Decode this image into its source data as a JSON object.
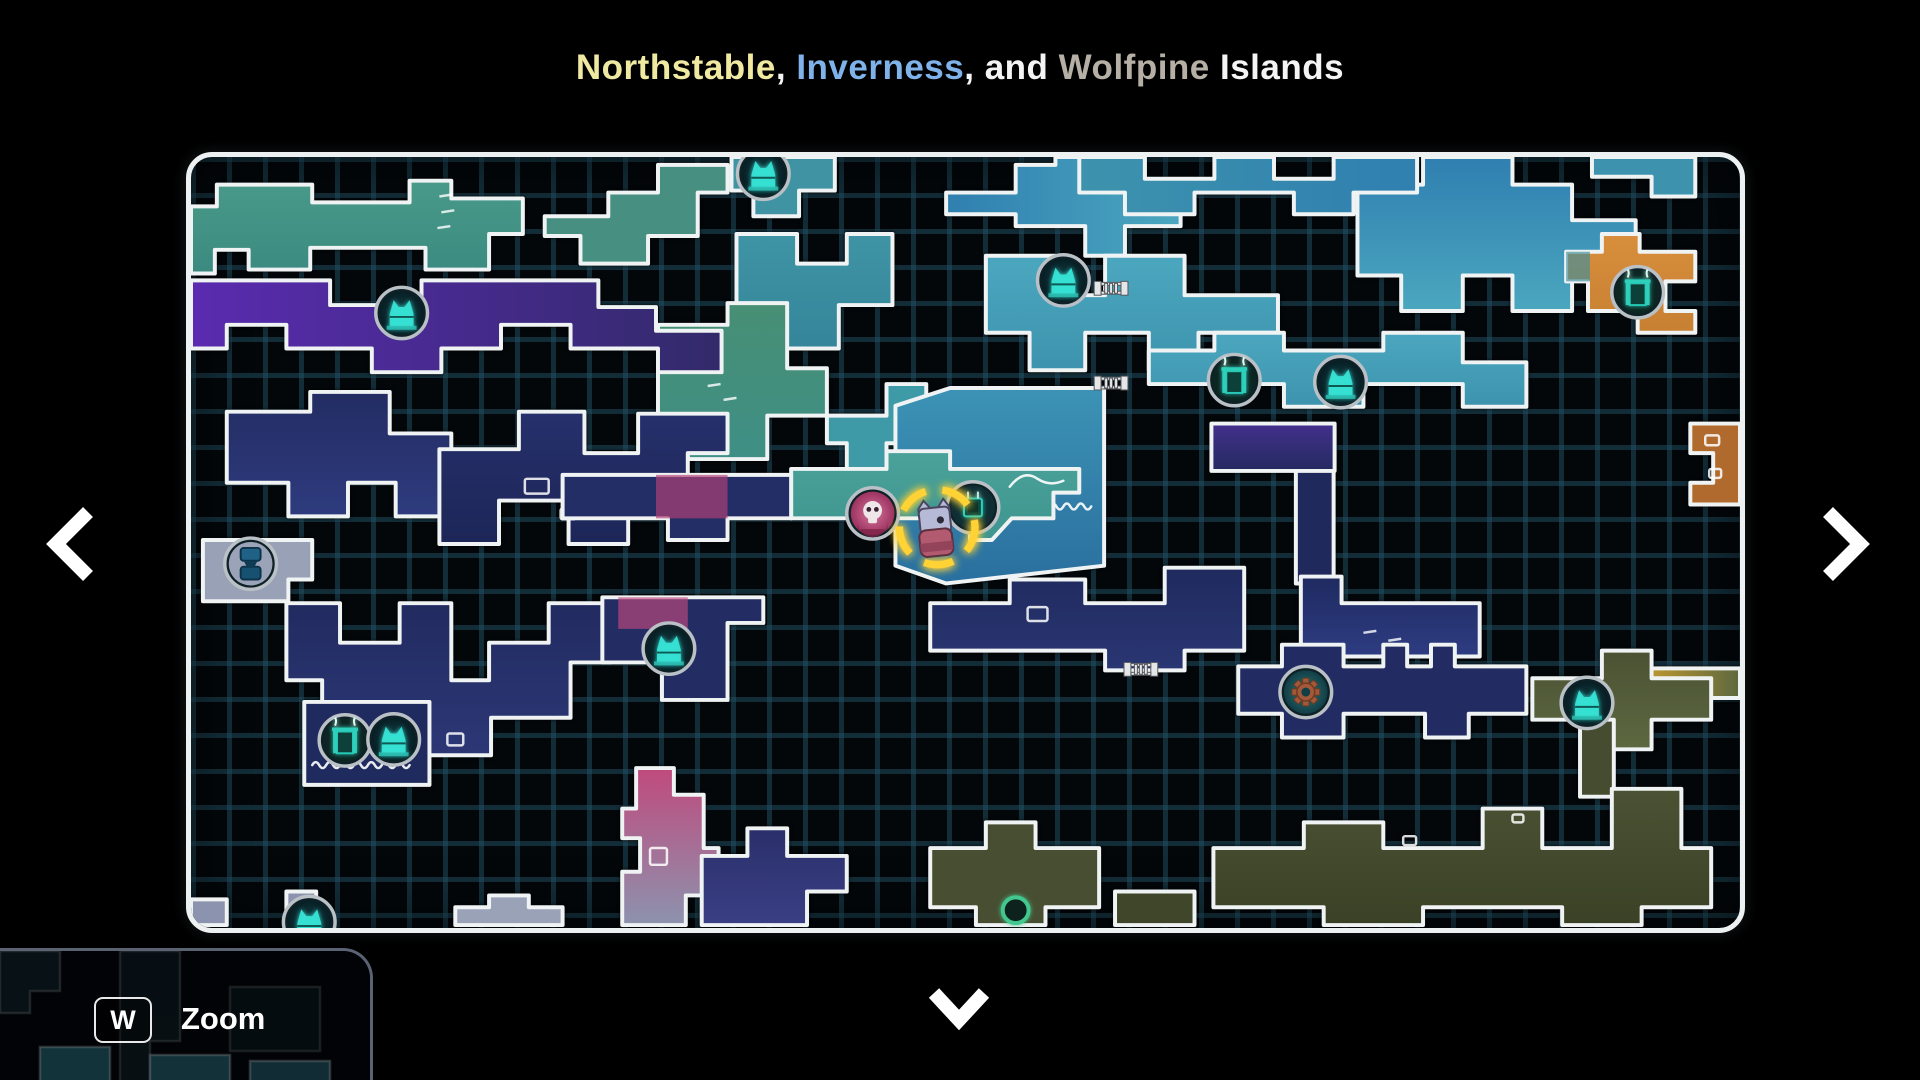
{
  "title": {
    "segments": [
      {
        "text": "Northstable",
        "color": "#efe9a1"
      },
      {
        "text": ", ",
        "color": "#f4f4f4"
      },
      {
        "text": "Inverness",
        "color": "#7fb2e8"
      },
      {
        "text": ", and ",
        "color": "#f4f4f4"
      },
      {
        "text": "Wolfpine",
        "color": "#b5afa5"
      },
      {
        "text": " Islands",
        "color": "#f4f4f4"
      }
    ]
  },
  "zoom_hint": {
    "key": "W",
    "label": "Zoom"
  },
  "nav": {
    "left": "previous-map",
    "right": "next-map",
    "down": "pan-down"
  },
  "map": {
    "colors": {
      "panel_border": "#eef1f1",
      "grid_line": "#225266",
      "room_outline": "#f0f3f3",
      "marker_yellow": "#ffd234",
      "icon_ring": "#b9c0c6",
      "statue_teal": "#36e2d4"
    },
    "rooms": [
      {
        "n": "room-top-left-green",
        "f": "#4a9a8a",
        "f2": "#3a8a80",
        "d": "v",
        "pts": "0,50 26,50 26,28 122,28 122,46 220,46 220,24 262,24 262,42 334,42 334,78 300,78 300,114 236,114 236,92 120,92 120,114 58,114 58,94 24,94 24,118 0,118",
        "details": [
          {
            "t": "dash",
            "x": 250,
            "y": 40
          },
          {
            "t": "dash",
            "x": 252,
            "y": 56
          },
          {
            "t": "dash",
            "x": 248,
            "y": 72
          }
        ]
      },
      {
        "n": "room-top-left-green2",
        "f": "#478f80",
        "pts": "356,60 420,60 420,36 470,36 470,8 540,8 540,36 510,36 510,80 460,80 460,108 392,108 392,80 356,80"
      },
      {
        "n": "room-top-gate",
        "f": "#3f93a2",
        "pts": "544,0 648,0 648,34 612,34 612,60 566,60 566,34 544,34"
      },
      {
        "n": "room-top-mid-chain",
        "f": "#3e94a4",
        "f2": "#35859a",
        "pts": "549,78 610,78 610,108 660,108 660,78 706,78 706,150 652,150 652,194 596,194 596,150 549,150"
      },
      {
        "n": "room-mid-green",
        "f": "#478f74",
        "f2": "#3f8f86",
        "pts": "470,170 540,170 540,148 600,148 600,214 640,214 640,262 580,262 580,306 500,306 500,262 470,262",
        "details": [
          {
            "t": "dash",
            "x": 520,
            "y": 232
          },
          {
            "t": "dash",
            "x": 536,
            "y": 246
          }
        ]
      },
      {
        "n": "room-pre-player",
        "f": "#3f9aa8",
        "pts": "640,262 700,262 700,230 740,230 740,290 700,290 700,330 660,330 660,290 640,290"
      },
      {
        "n": "room-top-blue",
        "f": "#2f7fb0",
        "f2": "#4ba7bf",
        "d": "h",
        "pts": "760,36 830,36 830,8 870,8 870,0 960,0 960,36 996,36 996,70 940,70 940,100 900,100 900,70 830,70 830,58 760,58"
      },
      {
        "n": "room-upper-center",
        "f": "#4ba7bf",
        "f2": "#3d93ad",
        "pts": "800,100 870,100 870,140 920,140 920,100 1000,100 1000,140 1094,140 1094,178 1014,178 1014,216 964,216 964,178 900,178 900,216 844,216 844,178 800,178"
      },
      {
        "n": "room-water",
        "f": "#3c93b5",
        "f2": "#2a6f9f",
        "pts": "709,252 764,234 919,234 919,414 760,432 709,414",
        "details": [
          {
            "t": "arc",
            "x": 806,
            "y": 340
          },
          {
            "t": "wave",
            "x1": 738,
            "x2": 912,
            "y": 354
          }
        ]
      },
      {
        "n": "room-player-band",
        "f": "#4aa29a",
        "f2": "#3f958f",
        "pts": "604,316 700,316 700,298 764,298 764,316 894,316 894,340 868,340 868,366 826,366 806,388 784,388 784,366 604,366",
        "details": [
          {
            "t": "arc",
            "x": 852,
            "y": 334
          }
        ]
      },
      {
        "n": "room-purple-band",
        "f": "#5a2bb0",
        "f2": "#322a6a",
        "d": "h",
        "pts": "0,125 140,125 140,150 232,150 232,125 410,125 410,152 468,152 468,176 534,176 534,218 470,218 470,194 382,194 382,170 312,170 312,194 252,194 252,218 182,218 182,194 96,194 96,170 36,170 36,194 0,194"
      },
      {
        "n": "room-ml-maze",
        "f": "#232c63",
        "f2": "#2e3b7e",
        "pts": "36,258 120,258 120,238 200,238 200,280 262,280 262,364 206,364 206,330 158,330 158,364 98,364 98,330 36,330"
      },
      {
        "n": "room-gray",
        "f": "#99a1b7",
        "pts": "12,388 122,388 122,428 98,428 98,450 12,450"
      },
      {
        "n": "room-c-maze1",
        "f": "#26306b",
        "f2": "#1d2657",
        "pts": "250,296 330,296 330,258 396,258 396,300 450,300 450,260 540,260 540,300 500,300 500,348 440,348 440,392 380,392 380,348 310,348 310,392 250,392",
        "details": [
          {
            "t": "rect",
            "x": 336,
            "y": 326,
            "w": 24,
            "h": 15
          },
          {
            "t": "rect",
            "x": 382,
            "y": 330,
            "w": 11,
            "h": 9
          },
          {
            "t": "rect",
            "x": 372,
            "y": 356,
            "w": 15,
            "h": 11
          }
        ]
      },
      {
        "n": "room-c-maze2",
        "f": "#222b60",
        "f2": "#2c3776",
        "pts": "96,452 150,452 150,492 210,492 210,452 262,452 262,530 300,530 300,492 360,492 360,452 422,452 422,512 382,512 382,568 302,568 302,606 222,606 222,568 132,568 132,530 96,530",
        "details": [
          {
            "t": "rect",
            "x": 258,
            "y": 584,
            "w": 16,
            "h": 12
          }
        ]
      },
      {
        "n": "room-bl-dock",
        "f": "#1f2a5e",
        "pts": "114,552 240,552 240,636 114,636",
        "details": [
          {
            "t": "wave",
            "x1": 122,
            "x2": 232,
            "y": 616
          }
        ]
      },
      {
        "n": "room-cat-mid",
        "f": "#232d64",
        "pts": "414,446 576,446 576,472 540,472 540,550 474,550 474,512 414,512",
        "details": [
          {
            "t": "patch",
            "pts": "430,446 500,446 500,478 430,478",
            "f": "#c04a7d"
          }
        ]
      },
      {
        "n": "room-c-band",
        "f": "#242e66",
        "pts": "374,322 604,322 604,366 540,366 540,388 480,388 480,366 374,366",
        "details": [
          {
            "t": "patch",
            "pts": "468,322 540,322 540,366 468,366",
            "f": "#b64177"
          }
        ]
      },
      {
        "n": "room-pink-drop",
        "f": "#c04a7d",
        "f2": "#8c93ae",
        "pts": "448,619 486,619 486,646 516,646 516,700 531,700 531,748 498,748 498,778 434,778 434,724 452,724 452,690 434,690 434,660 448,660",
        "details": [
          {
            "t": "rect",
            "x": 462,
            "y": 700,
            "w": 17,
            "h": 17
          }
        ]
      },
      {
        "n": "room-bl-gray1",
        "f": "#8c93ae",
        "pts": "0,752 36,752 36,778 0,778"
      },
      {
        "n": "room-bl-gray2",
        "f": "#8c93ae",
        "pts": "96,744 126,744 126,778 96,778"
      },
      {
        "n": "room-bl-gray3",
        "f": "#9aa2b8",
        "pts": "266,760 300,760 300,748 340,748 340,760 374,760 374,778 266,778"
      },
      {
        "n": "room-bc-navy",
        "f": "#2a2f6a",
        "f2": "#3a3f85",
        "pts": "514,708 560,708 560,680 600,680 600,708 660,708 660,744 620,744 620,778 514,778"
      },
      {
        "n": "room-center",
        "f": "#1f2a5e",
        "f2": "#2a3673",
        "pts": "744,452 824,452 824,428 900,428 900,452 980,452 980,416 1060,416 1060,500 1000,500 1000,520 920,520 920,500 744,500",
        "details": [
          {
            "t": "rect",
            "x": 842,
            "y": 456,
            "w": 20,
            "h": 14
          }
        ]
      },
      {
        "n": "room-tower-top",
        "f": "#43308c",
        "f2": "#242a60",
        "pts": "1027,270 1151,270 1151,318 1027,318"
      },
      {
        "n": "room-tower-col",
        "f": "#20295c",
        "pts": "1112,318 1150,318 1150,432 1112,432"
      },
      {
        "n": "room-tower-passage",
        "f": "#1f2a60",
        "f2": "#2e3c82",
        "pts": "1117,425 1158,425 1158,452 1297,452 1297,506 1117,506",
        "details": [
          {
            "t": "dash",
            "x": 1180,
            "y": 482
          },
          {
            "t": "dash",
            "x": 1205,
            "y": 490
          }
        ]
      },
      {
        "n": "room-gear",
        "f": "#222c62",
        "pts": "1054,516 1098,516 1098,494 1160,494 1160,516 1200,516 1200,494 1224,494 1224,516 1248,516 1248,494 1272,494 1272,516 1344,516 1344,564 1286,564 1286,588 1242,588 1242,564 1160,564 1160,588 1098,588 1098,564 1054,564"
      },
      {
        "n": "room-right-teal",
        "f": "#4ba7bf",
        "f2": "#3d93ad",
        "pts": "964,196 1030,196 1030,178 1100,178 1100,196 1200,196 1200,178 1280,178 1280,208 1344,208 1344,253 1280,253 1280,230 1180,230 1180,253 1100,253 1100,230 964,230"
      },
      {
        "n": "room-tr-blue",
        "f": "#2f7fb0",
        "f2": "#4ba7bf",
        "pts": "1174,28 1240,28 1240,0 1330,0 1330,28 1390,28 1390,64 1454,64 1454,120 1390,120 1390,156 1330,156 1330,120 1280,120 1280,156 1218,156 1218,120 1174,120"
      },
      {
        "n": "room-orange",
        "f": "#d88f3c",
        "f2": "#c77f32",
        "pts": "1384,96 1420,96 1420,78 1458,78 1458,96 1514,96 1514,126 1484,126 1484,156 1514,156 1514,178 1456,178 1456,156 1406,156 1406,126 1384,126",
        "details": [
          {
            "t": "patch",
            "pts": "1384,96 1408,96 1408,126 1384,126",
            "f": "#3d8f9e"
          }
        ]
      },
      {
        "n": "room-tr-top",
        "f": "#3d93ad",
        "pts": "1410,0 1514,0 1514,40 1470,40 1470,20 1410,20"
      },
      {
        "n": "room-tr-band",
        "f": "#3d93ad",
        "f2": "#2f7fb0",
        "d": "h",
        "pts": "894,0 960,0 960,22 1030,22 1030,0 1090,0 1090,22 1150,22 1150,0 1234,0 1234,36 1170,36 1170,58 1110,58 1110,36 1010,36 1010,58 940,58 940,36 894,36"
      },
      {
        "n": "room-right-rust",
        "f": "#b06a2e",
        "pts": "1509,270 1559,270 1559,352 1509,352 1509,330 1532,330 1532,300 1509,300",
        "details": [
          {
            "t": "rect",
            "x": 1524,
            "y": 282,
            "w": 14,
            "h": 10
          },
          {
            "t": "rect",
            "x": 1528,
            "y": 316,
            "w": 12,
            "h": 9
          }
        ]
      },
      {
        "n": "room-right-gold",
        "f": "#c1992f",
        "f2": "#5d6840",
        "d": "h",
        "pts": "1464,518 1559,518 1559,548 1464,548"
      },
      {
        "n": "room-olive-cat",
        "f": "#4b5234",
        "f2": "#5d6840",
        "pts": "1350,528 1420,528 1420,500 1470,500 1470,528 1530,528 1530,570 1470,570 1470,600 1420,600 1420,570 1350,570"
      },
      {
        "n": "room-olive-link",
        "f": "#454c30",
        "pts": "1398,570 1432,570 1432,648 1398,648"
      },
      {
        "n": "room-olive-band",
        "f": "#4b5234",
        "f2": "#3a4126",
        "pts": "1029,700 1120,700 1120,674 1200,674 1200,700 1300,700 1300,660 1360,660 1360,700 1430,700 1430,640 1500,640 1500,700 1530,700 1530,760 1460,760 1460,778 1380,778 1380,760 1240,760 1240,778 1140,778 1140,760 1029,760",
        "details": [
          {
            "t": "rect",
            "x": 1220,
            "y": 688,
            "w": 13,
            "h": 9
          },
          {
            "t": "rect",
            "x": 1330,
            "y": 666,
            "w": 11,
            "h": 8
          }
        ]
      },
      {
        "n": "room-olive-left",
        "f": "#474e31",
        "pts": "744,700 800,700 800,674 850,674 850,700 914,700 914,760 860,760 860,778 790,778 790,760 744,760"
      },
      {
        "n": "room-olive-strip",
        "f": "#3f4629",
        "pts": "930,744 1010,744 1010,778 930,778"
      }
    ],
    "icons": [
      {
        "type": "ladder",
        "x": 926,
        "y": 133
      },
      {
        "type": "ladder",
        "x": 926,
        "y": 229
      },
      {
        "type": "ladder",
        "x": 956,
        "y": 519
      },
      {
        "type": "cat-statue",
        "x": 576,
        "y": 17
      },
      {
        "type": "cat-statue",
        "x": 878,
        "y": 125
      },
      {
        "type": "cat-statue",
        "x": 212,
        "y": 158
      },
      {
        "type": "gate",
        "x": 1050,
        "y": 226
      },
      {
        "type": "cat-statue",
        "x": 1157,
        "y": 228
      },
      {
        "type": "gate",
        "x": 1456,
        "y": 137
      },
      {
        "type": "totem",
        "x": 60,
        "y": 412
      },
      {
        "type": "cat-statue",
        "x": 481,
        "y": 498
      },
      {
        "type": "gate",
        "x": 155,
        "y": 591
      },
      {
        "type": "cat-statue",
        "x": 204,
        "y": 590
      },
      {
        "type": "gear",
        "x": 1122,
        "y": 542
      },
      {
        "type": "cat-statue",
        "x": 1405,
        "y": 553
      },
      {
        "type": "cat-statue",
        "x": 119,
        "y": 775
      },
      {
        "type": "ring",
        "x": 830,
        "y": 763
      },
      {
        "type": "skull",
        "x": 686,
        "y": 361
      },
      {
        "type": "save-bench",
        "x": 787,
        "y": 355
      },
      {
        "type": "player",
        "x": 751,
        "y": 375
      }
    ]
  },
  "minimap": {
    "rooms": [
      {
        "pts": "0,0 60,0 60,40 30,40 30,62 0,62",
        "f": "#1c3743",
        "o": 0.55
      },
      {
        "pts": "120,0 180,0 180,90 150,90 150,132 120,132",
        "f": "#16313c",
        "o": 0.5
      },
      {
        "pts": "230,36 320,36 320,100 230,100",
        "f": "#132a33",
        "o": 0.45
      },
      {
        "pts": "40,96 110,96 110,132 40,132",
        "f": "#2a6d7e",
        "o": 0.85
      },
      {
        "pts": "150,104 230,104 230,132 150,132",
        "f": "#28687a",
        "o": 0.85
      },
      {
        "pts": "250,110 330,110 330,132 250,132",
        "f": "#245f70",
        "o": 0.85
      }
    ]
  }
}
